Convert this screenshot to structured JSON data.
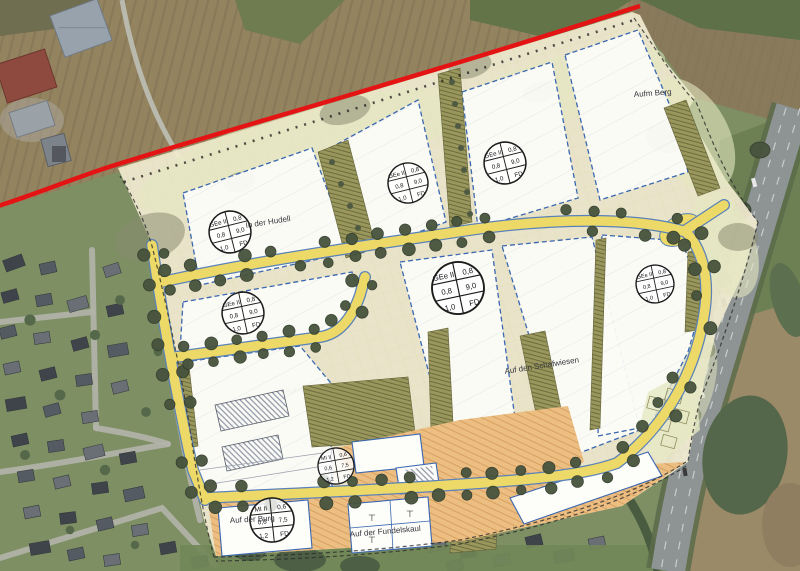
{
  "map": {
    "labels": {
      "hudell": "In der Hudell",
      "schafwiesen": "Auf den Schafwiesen",
      "aufm_berg": "Aufm Berg",
      "burg": "Auf der Burg",
      "fundelskaul": "Auf der Fundelskaul",
      "partial": "Auf der"
    },
    "stamps": {
      "ge": {
        "r1l": "GEe II",
        "r1r": "0,8",
        "r2l": "0,8",
        "r2r": "9,0",
        "r3l": "1,0",
        "r3r": "FD"
      },
      "mi": {
        "r1l": "MI II",
        "r1r": "0,6",
        "r2l": "0,6",
        "r2r": "7,5",
        "r3l": "1,2",
        "r3r": "FD"
      }
    },
    "symbols": {
      "t_mark": "⊤"
    },
    "colors": {
      "boundary_red": "#e41414",
      "road_yellow": "#ecd967",
      "road_edge_blue": "#5b82b8",
      "plan_beige": "#f2ecd1",
      "strip_olive": "#9a975c",
      "mixed_use_orange": "#ecbe82",
      "parcel_white": "#fcfcf8",
      "parcel_border_blue": "#3a67b0",
      "tree_green": "#47533d"
    }
  }
}
